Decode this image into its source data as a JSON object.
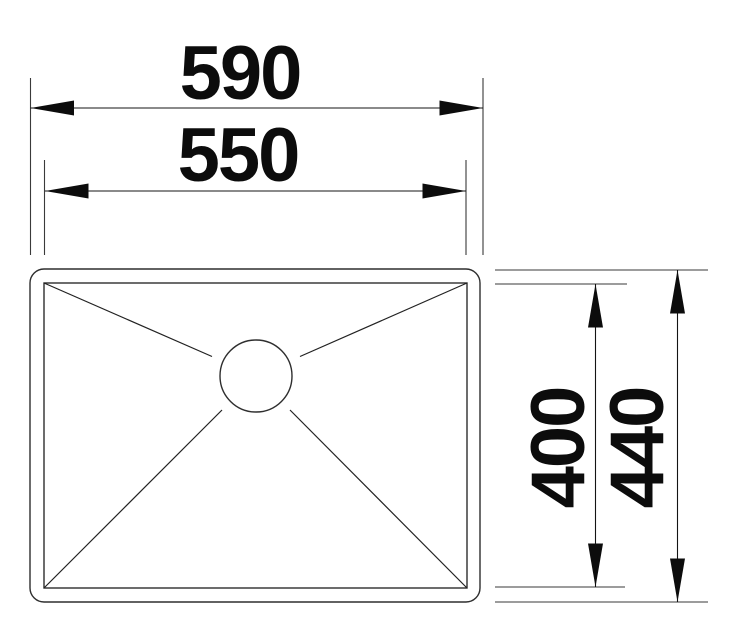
{
  "drawing": {
    "type": "technical-dimension-drawing",
    "subject": "sink-top-view",
    "dimensions": {
      "outer_width": "590",
      "inner_width": "550",
      "inner_depth": "400",
      "outer_depth": "440"
    },
    "colors": {
      "line": "#141414",
      "object": "#2e2e2e",
      "text": "#0c0c0c",
      "background": "#ffffff"
    }
  }
}
